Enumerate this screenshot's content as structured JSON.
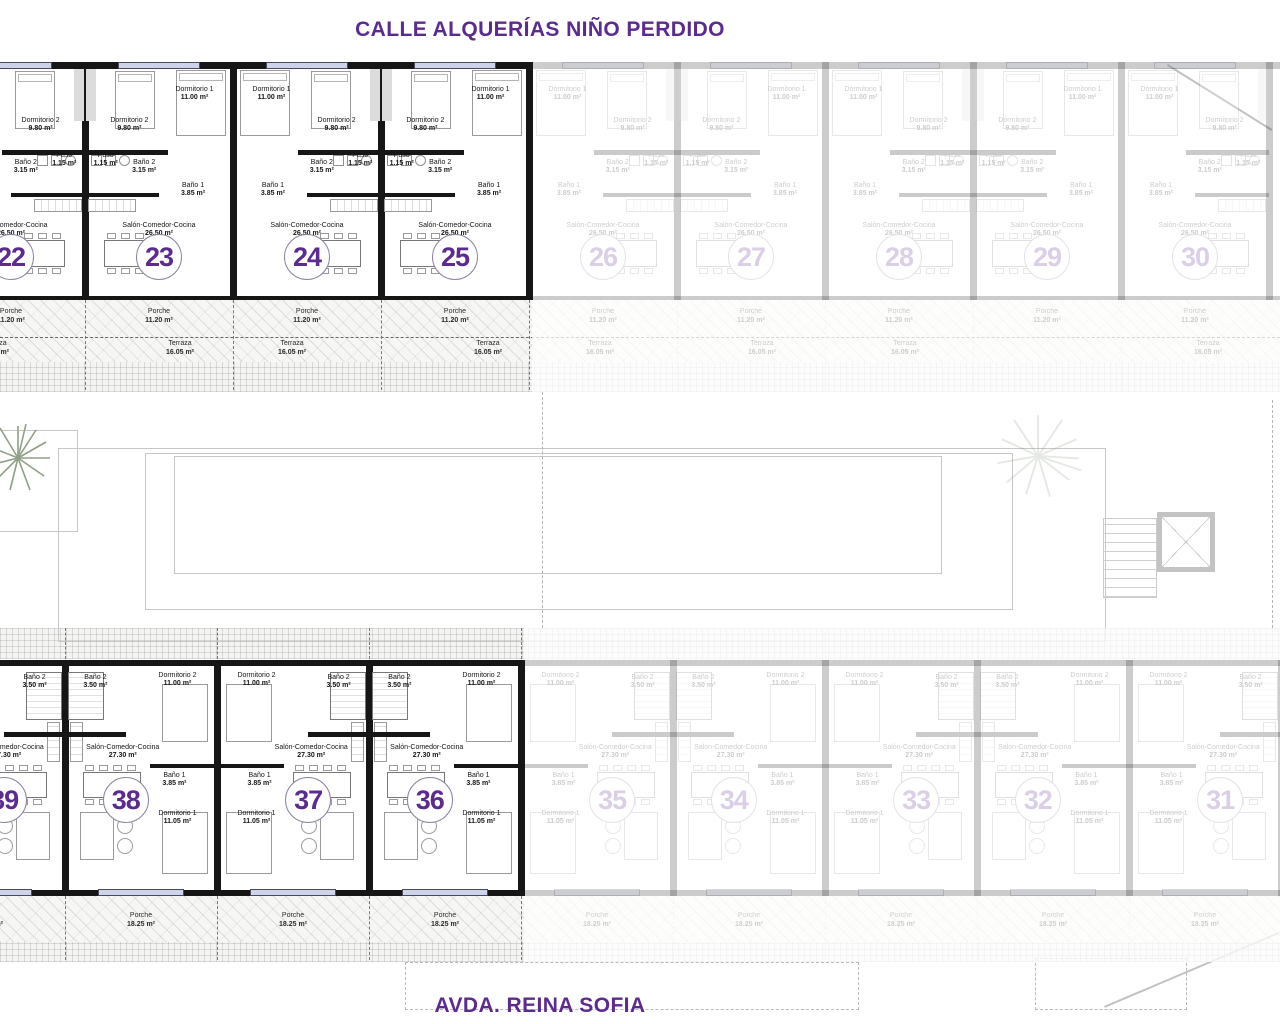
{
  "titles": {
    "top": "CALLE ALQUERÍAS NIÑO PERDIDO",
    "bottom": "AVDA. REINA SOFIA"
  },
  "colors": {
    "accent_purple": "#5b2b8f",
    "wall_black": "#161616",
    "window_fill": "#ccd3ea"
  },
  "top_row": {
    "rooms": {
      "dorm1": {
        "name": "Dormitorio 1",
        "area": "11.00 m²"
      },
      "dorm2": {
        "name": "Dormitorio 2",
        "area": "9.80 m²"
      },
      "paso": {
        "name": "Paso",
        "area": "1.15 m²"
      },
      "bano2": {
        "name": "Baño 2",
        "area": "3.15 m²"
      },
      "bano1": {
        "name": "Baño 1",
        "area": "3.85 m²"
      },
      "salon": {
        "name": "Salón-Comedor-Cocina",
        "area": "26.50 m²"
      },
      "porche": {
        "name": "Porche",
        "area": "11.20 m²"
      },
      "terraza": {
        "name": "Terraza",
        "area": "16.05 m²"
      }
    },
    "units": [
      {
        "number": "22",
        "highlighted": true
      },
      {
        "number": "23",
        "highlighted": true
      },
      {
        "number": "24",
        "highlighted": true
      },
      {
        "number": "25",
        "highlighted": true
      },
      {
        "number": "26",
        "highlighted": false
      },
      {
        "number": "27",
        "highlighted": false
      },
      {
        "number": "28",
        "highlighted": false
      },
      {
        "number": "29",
        "highlighted": false
      },
      {
        "number": "30",
        "highlighted": false
      }
    ]
  },
  "bottom_row": {
    "rooms": {
      "bano2": {
        "name": "Baño 2",
        "area": "3.50 m²"
      },
      "dorm2": {
        "name": "Dormitorio 2",
        "area": "11.00 m²"
      },
      "salon": {
        "name": "Salón-Comedor-Cocina",
        "area": "27.30 m²"
      },
      "bano1": {
        "name": "Baño 1",
        "area": "3.85 m²"
      },
      "dorm1": {
        "name": "Dormitorio 1",
        "area": "11.05 m²"
      },
      "porche": {
        "name": "Porche",
        "area": "18.25 m²"
      }
    },
    "units": [
      {
        "number": "39",
        "highlighted": true
      },
      {
        "number": "38",
        "highlighted": true
      },
      {
        "number": "37",
        "highlighted": true
      },
      {
        "number": "36",
        "highlighted": true
      },
      {
        "number": "35",
        "highlighted": false
      },
      {
        "number": "34",
        "highlighted": false
      },
      {
        "number": "33",
        "highlighted": false
      },
      {
        "number": "32",
        "highlighted": false
      },
      {
        "number": "31",
        "highlighted": false
      }
    ]
  }
}
